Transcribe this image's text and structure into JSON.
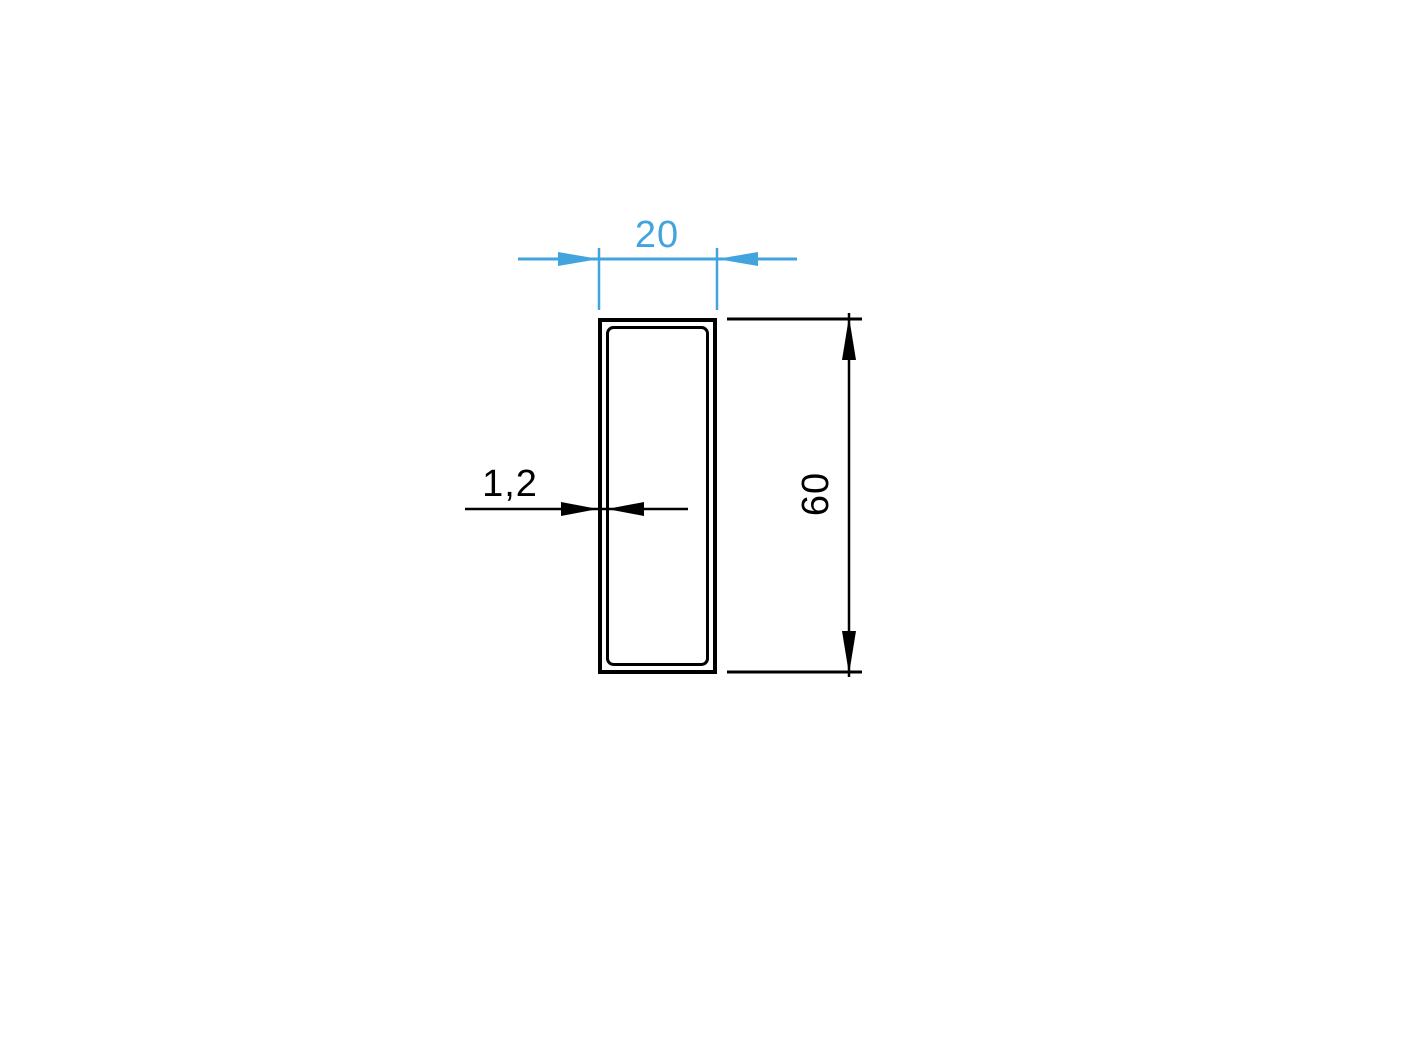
{
  "colors": {
    "accent_blue": "#42A4DD",
    "line_black": "#000000",
    "background": "#FFFFFF"
  },
  "dimensions": {
    "width": {
      "label": "20"
    },
    "height": {
      "label": "60"
    },
    "thickness": {
      "label": "1,2"
    }
  }
}
